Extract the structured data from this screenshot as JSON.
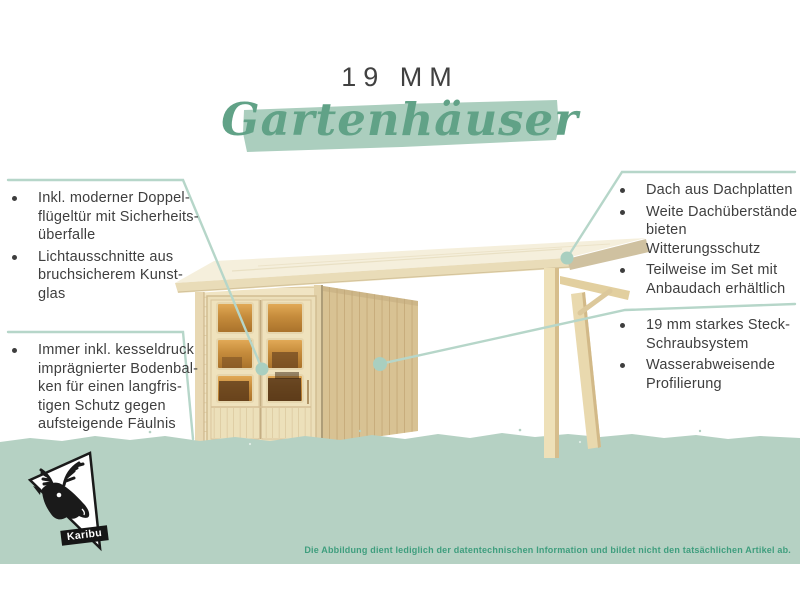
{
  "header": {
    "size_label": "19 MM",
    "title_script": "Gartenhäuser"
  },
  "callouts": {
    "left_top": {
      "items": [
        {
          "text": "Inkl. moderner Doppel-\nflügeltür mit Sicherheits-\nüberfalle"
        },
        {
          "text": "Lichtausschnitte aus\nbruchsicherem Kunst-\nglas"
        }
      ]
    },
    "left_bottom": {
      "items": [
        {
          "text": "Immer inkl. kesseldruck\nimprägnierter Bodenbal-\nken für einen langfris-\ntigen Schutz gegen\naufsteigende Fäulnis"
        }
      ]
    },
    "right_top": {
      "items": [
        {
          "text": "Dach aus Dachplatten"
        },
        {
          "text": "Weite Dachüberstände\nbieten Witterungsschutz"
        },
        {
          "text": "Teilweise im Set mit\nAnbaudach erhältlich"
        }
      ]
    },
    "right_bottom": {
      "items": [
        {
          "text": "19 mm starkes Steck-\nSchraubsystem"
        },
        {
          "text": "Wasserabweisende\nProfilierung"
        }
      ]
    }
  },
  "footer": {
    "disclaimer": "Die Abbildung dient lediglich der datentechnischen Information und bildet nicht den tatsächlichen Artikel ab.",
    "logo_label": "Karibu"
  },
  "colors": {
    "accent_green": "#61a287",
    "brush_green": "#abcebe",
    "band_green": "#b5d1c3",
    "callout_line_green": "#b6d6c9",
    "disclaimer_green": "#3f9e7e",
    "text_dark": "#3e3e3e",
    "wood_light": "#f0e4c3",
    "wood_dark": "#d8c293",
    "window_amber": "#c68c3c"
  }
}
